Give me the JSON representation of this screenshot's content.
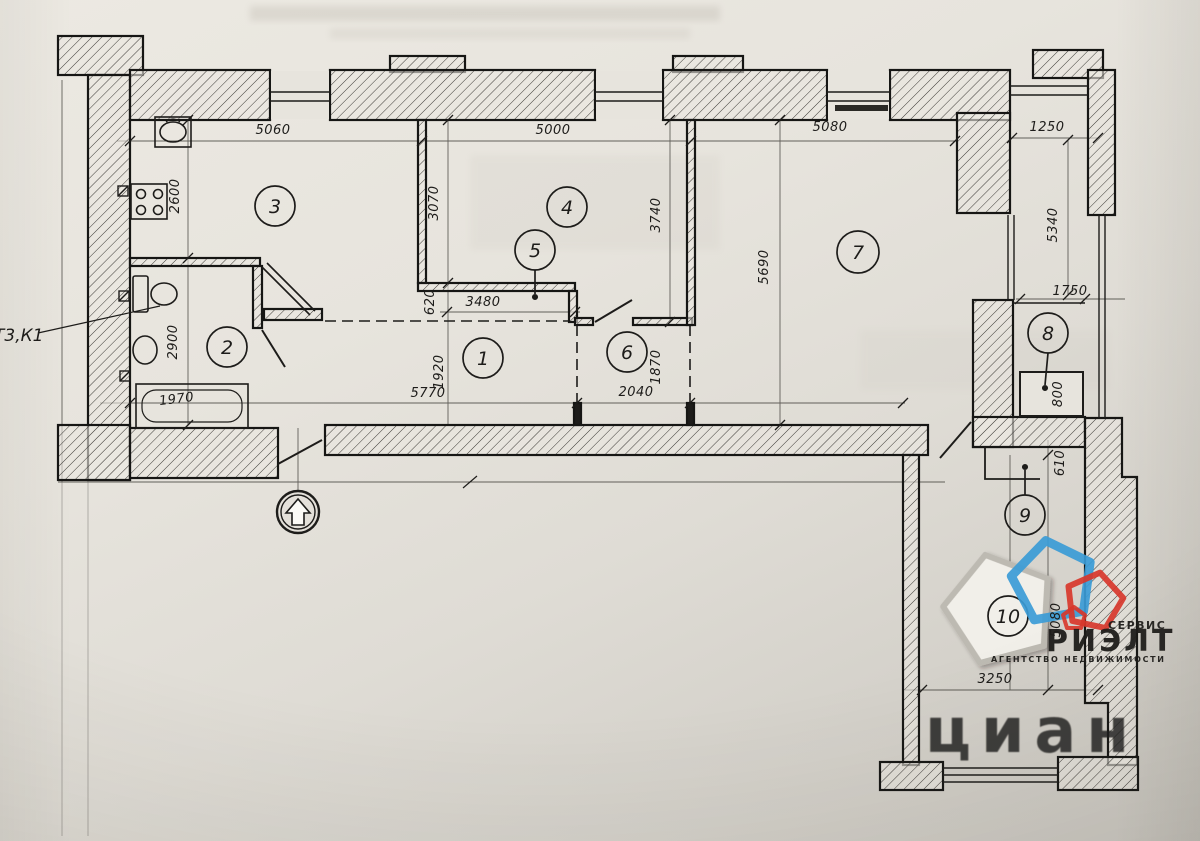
{
  "plan": {
    "wall_mark": "Т3,К1",
    "rooms": {
      "r1": "1",
      "r2": "2",
      "r3": "3",
      "r4": "4",
      "r5": "5",
      "r6": "6",
      "r7": "7",
      "r8": "8",
      "r9": "9",
      "r10": "10"
    },
    "dims": {
      "kitchen_top": "5060",
      "room4_top": "5000",
      "room7_top": "5080",
      "loggia_top": "1250",
      "kitchen_left": "2600",
      "room4_left": "3070",
      "room4_right": "3740",
      "room7_left": "5690",
      "loggia_right": "5340",
      "niche_width": "3480",
      "niche_depth": "620",
      "hall_width": "5770",
      "hall_height": "1920",
      "room6_width": "2040",
      "room6_height": "1870",
      "bath_height": "2900",
      "bathtub": "1970",
      "room8_width": "1750",
      "room8_depth": "800",
      "room9_depth": "610",
      "room10_width": "3250",
      "room10_height": "5080"
    }
  },
  "logo": {
    "service": "СЕРВИС",
    "brand": "РИЭЛТ",
    "tagline": "АГЕНТСТВО  НЕДВИЖИМОСТИ"
  },
  "watermark": {
    "text": "циан"
  },
  "colors": {
    "logo_blue": "#3b9bd6",
    "logo_red": "#d8372b",
    "paper": "#e7e4dd",
    "ink": "#1d1c1a"
  }
}
